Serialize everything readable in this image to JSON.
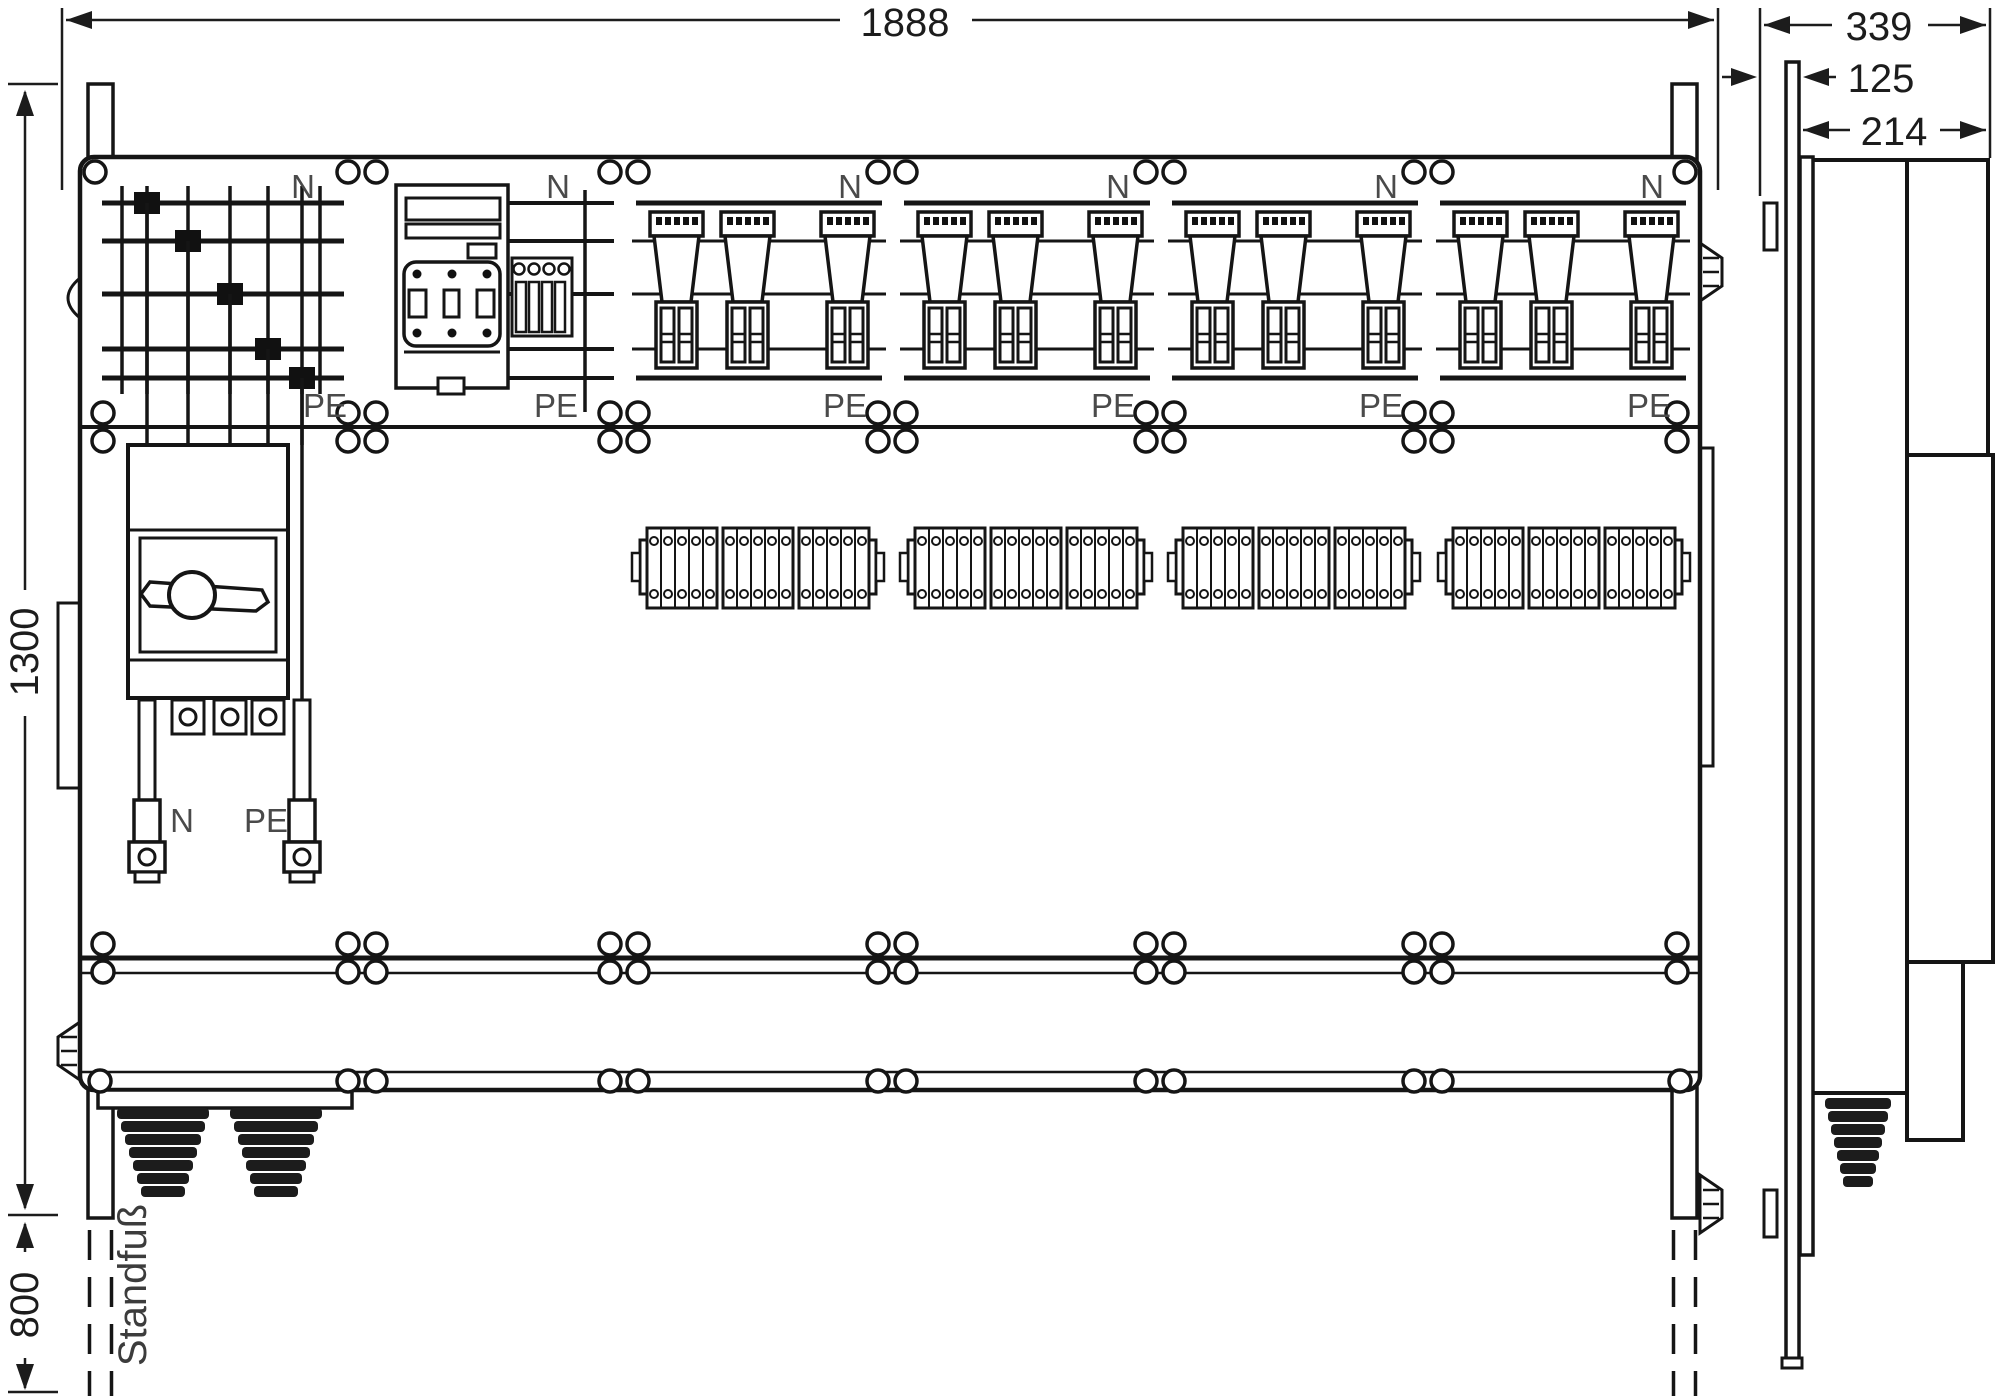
{
  "drawing_title": "distribution-cabinet-dimension-drawing",
  "dimensions": {
    "total_width": "1888",
    "cabinet_height": "1300",
    "stand_height": "800",
    "side_total_depth": "339",
    "side_wall_clearance": "125",
    "side_body_depth": "214"
  },
  "labels": {
    "neutral": "N",
    "protective_earth": "PE",
    "stand": "Standfuß"
  }
}
